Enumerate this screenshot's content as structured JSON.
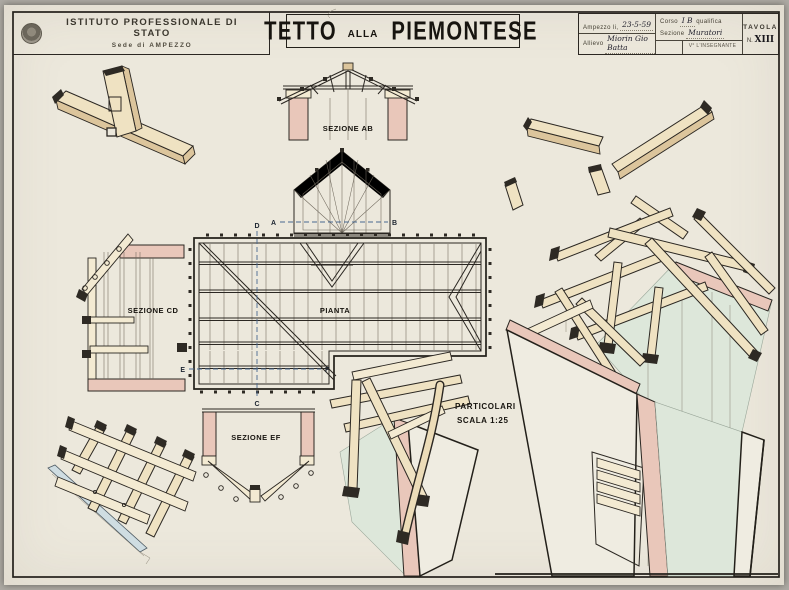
{
  "header": {
    "school_name": "ISTITUTO PROFESSIONALE DI STATO",
    "school_location": "Sede di AMPEZZO",
    "title": {
      "main1": "TETTO",
      "connector": "alla",
      "main2": "PIEMONTESE"
    },
    "info": {
      "place_date_label": "Ampezzo li,",
      "place_date_value": "23-5-59",
      "course_label": "Corso",
      "course_value": "I B",
      "qualifica_label": "qualifica",
      "section_label": "Sezione",
      "section_value": "Muratori",
      "student_label": "Allievo",
      "student_value": "Miorin Gio Batta",
      "teacher_visa_label": "V° L'INSEGNANTE",
      "tavola_label": "TAVOLA",
      "tavola_no_label": "N.",
      "tavola_number": "XIII"
    }
  },
  "labels": {
    "sezione_ab": "SEZIONE AB",
    "sezione_cd": "SEZIONE CD",
    "sezione_ef": "SEZIONE EF",
    "pianta": "PIANTA",
    "particolari_line1": "PARTICOLARI",
    "particolari_line2": "SCALA 1:25"
  },
  "markers": {
    "a": "A",
    "b": "B",
    "c": "C",
    "d": "D",
    "e": "E",
    "f": "F"
  },
  "colors": {
    "paper": "#ece8dc",
    "ink": "#2b2722",
    "wood_light": "#efe2c2",
    "wood_dark": "#dcc59c",
    "masonry_pink": "#e9c7ba",
    "wall_green": "#dde7da",
    "section_line_blue": "#49688f",
    "gutter_blue": "#cfdde2"
  }
}
